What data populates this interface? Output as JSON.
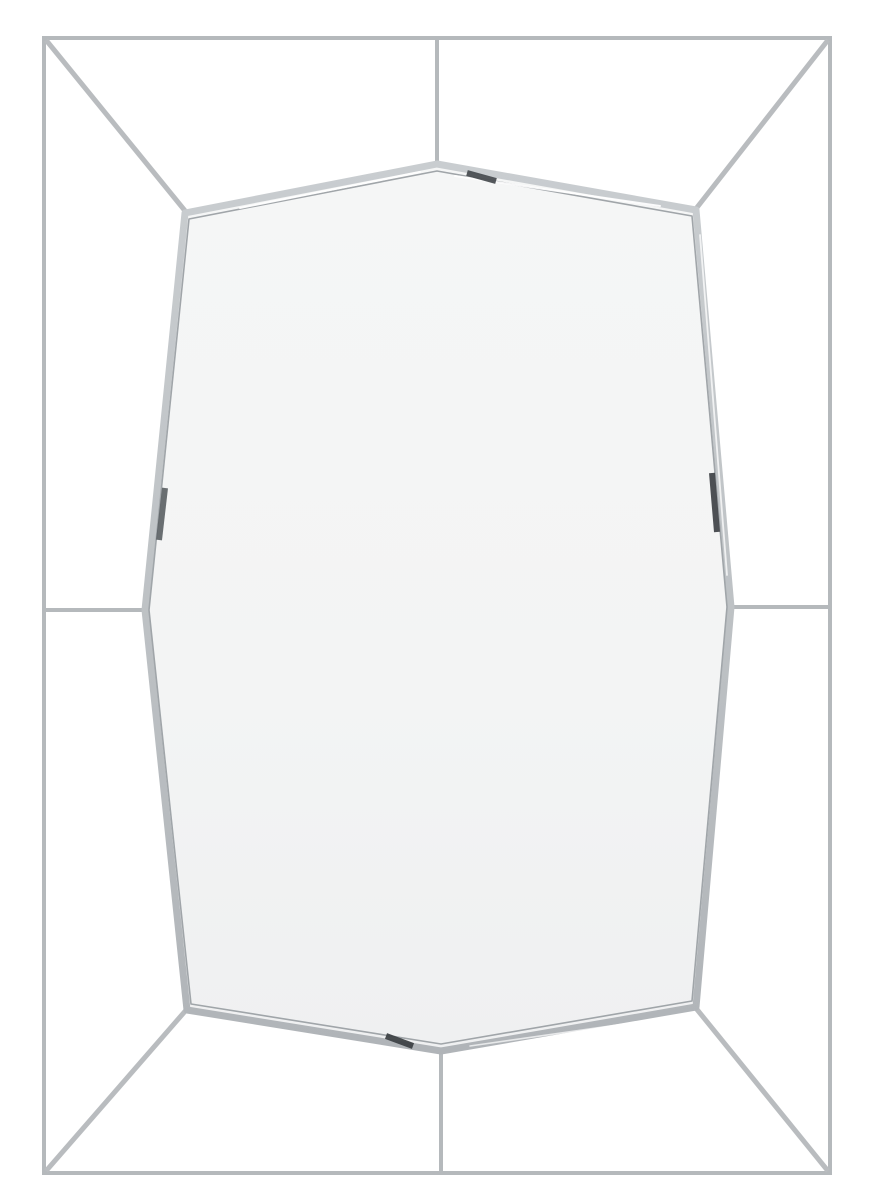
{
  "scene": {
    "alt_text": "Rectangular chrome wire-framed wall mirror with an elongated octagonal mirror glass panel connected to the outer frame by corner and mid-side struts, photographed on a white background",
    "canvas": {
      "width": 883,
      "height": 1200
    },
    "background": "#ffffff",
    "frame_color": "#b5b9bc",
    "diagonal_color": "#b9bcbf",
    "band_light": "#c9cdd0",
    "band_mid": "#bfc3c6",
    "band_dark": "#b0b4b8",
    "bevel_line": "#a0a5a9",
    "glass_top": "#f5f6f6",
    "glass_mid": "#f3f4f4",
    "glass_bottom": "#eff0f1",
    "outer_rect": {
      "x": 44,
      "y": 38,
      "width": 786,
      "height": 1135,
      "stroke_width": 4
    },
    "octagon_points": "437,164 696,210 731,607 696,1007 441,1051 187,1010 145,610 185,213",
    "octagon_inner_points": "437,171 692,216 727,607 692,1001 441,1044 191,1004 149,610 189,219",
    "band_stroke_width": 7,
    "bevel_stroke_width": 1.6,
    "struts": [
      {
        "name": "top-strut",
        "x1": 437,
        "y1": 40,
        "x2": 437,
        "y2": 164,
        "w": 4
      },
      {
        "name": "bottom-strut",
        "x1": 441,
        "y1": 1051,
        "x2": 441,
        "y2": 1171,
        "w": 4
      },
      {
        "name": "left-strut",
        "x1": 46,
        "y1": 610,
        "x2": 145,
        "y2": 610,
        "w": 4
      },
      {
        "name": "right-strut",
        "x1": 731,
        "y1": 607,
        "x2": 828,
        "y2": 607,
        "w": 4
      },
      {
        "name": "top-left-diagonal",
        "x1": 46,
        "y1": 40,
        "x2": 186,
        "y2": 212,
        "w": 5
      },
      {
        "name": "top-right-diagonal",
        "x1": 828,
        "y1": 40,
        "x2": 695,
        "y2": 210,
        "w": 5
      },
      {
        "name": "bottom-right-diagonal",
        "x1": 828,
        "y1": 1171,
        "x2": 695,
        "y2": 1007,
        "w": 5
      },
      {
        "name": "bottom-left-diagonal",
        "x1": 46,
        "y1": 1171,
        "x2": 187,
        "y2": 1009,
        "w": 5
      }
    ],
    "highlights": [
      {
        "name": "top-right-band-highlight",
        "x1": 455,
        "y1": 176,
        "x2": 660,
        "y2": 206,
        "w": 2,
        "color": "#ffffff",
        "opacity": 0.9
      },
      {
        "name": "top-left-band-highlight",
        "x1": 240,
        "y1": 208,
        "x2": 420,
        "y2": 172,
        "w": 2,
        "color": "#ffffff",
        "opacity": 0.9
      },
      {
        "name": "right-band-highlight",
        "x1": 700,
        "y1": 235,
        "x2": 727,
        "y2": 575,
        "w": 1.8,
        "color": "#ffffff",
        "opacity": 0.75
      },
      {
        "name": "bottom-right-band-highlight",
        "x1": 680,
        "y1": 1016,
        "x2": 470,
        "y2": 1046,
        "w": 1.6,
        "color": "#ffffff",
        "opacity": 0.7
      }
    ],
    "reflection_marks": [
      {
        "name": "apex-right-reflection",
        "x1": 467,
        "y1": 173,
        "x2": 496,
        "y2": 181,
        "w": 6,
        "color": "#4a4e52",
        "opacity": 0.95
      },
      {
        "name": "right-edge-reflection",
        "x1": 712,
        "y1": 473,
        "x2": 717,
        "y2": 532,
        "w": 6,
        "color": "#43474b",
        "opacity": 0.95
      },
      {
        "name": "left-edge-reflection",
        "x1": 165,
        "y1": 488,
        "x2": 159,
        "y2": 540,
        "w": 6,
        "color": "#5a5f63",
        "opacity": 0.9
      },
      {
        "name": "bottom-left-reflection",
        "x1": 386,
        "y1": 1036,
        "x2": 413,
        "y2": 1046,
        "w": 6,
        "color": "#3e4246",
        "opacity": 0.95
      }
    ]
  }
}
